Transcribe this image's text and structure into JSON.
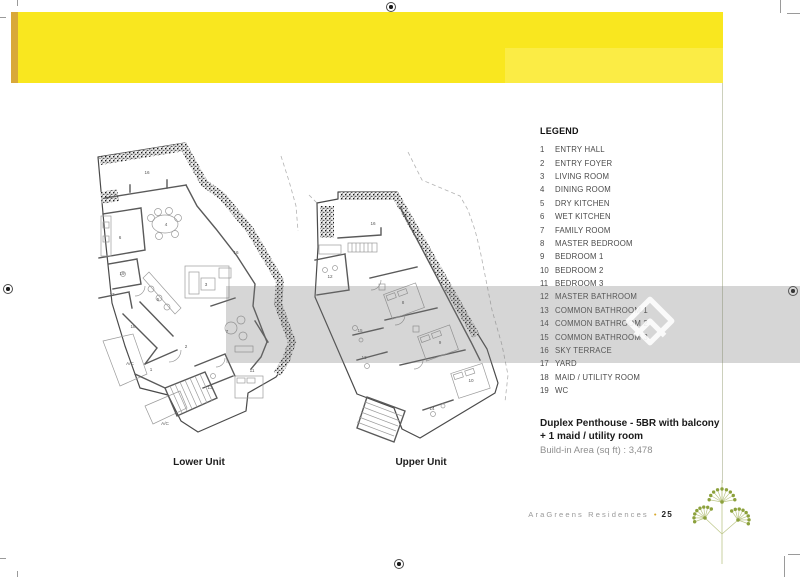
{
  "colors": {
    "banner_yellow": "#f9e71f",
    "banner_strip": "#d9a93a",
    "logo_green": "#8ca13c",
    "footer_bullet": "#d8a92c"
  },
  "legend": {
    "title": "LEGEND",
    "items": [
      {
        "num": "1",
        "label": "ENTRY HALL"
      },
      {
        "num": "2",
        "label": "ENTRY FOYER"
      },
      {
        "num": "3",
        "label": "LIVING ROOM"
      },
      {
        "num": "4",
        "label": "DINING ROOM"
      },
      {
        "num": "5",
        "label": "DRY KITCHEN"
      },
      {
        "num": "6",
        "label": "WET KITCHEN"
      },
      {
        "num": "7",
        "label": "FAMILY ROOM"
      },
      {
        "num": "8",
        "label": "MASTER BEDROOM"
      },
      {
        "num": "9",
        "label": "BEDROOM 1"
      },
      {
        "num": "10",
        "label": "BEDROOM 2"
      },
      {
        "num": "11",
        "label": "BEDROOM 3"
      },
      {
        "num": "12",
        "label": "MASTER BATHROOM"
      },
      {
        "num": "13",
        "label": "COMMON BATHROOM 1"
      },
      {
        "num": "14",
        "label": "COMMON BATHROOM 2"
      },
      {
        "num": "15",
        "label": "COMMON BATHROOM 3"
      },
      {
        "num": "16",
        "label": "SKY TERRACE"
      },
      {
        "num": "17",
        "label": "YARD"
      },
      {
        "num": "18",
        "label": "MAID / UTILITY ROOM"
      },
      {
        "num": "19",
        "label": "WC"
      }
    ]
  },
  "unit_info": {
    "title_line1": "Duplex Penthouse - 5BR with balcony",
    "title_line2": "+ 1 maid / utility room",
    "area_line": "Build-in Area (sq ft) : 3,478"
  },
  "plans": {
    "lower": {
      "caption": "Lower Unit",
      "labels": [
        {
          "t": "16",
          "x": 62,
          "y": 38
        },
        {
          "t": "4",
          "x": 81,
          "y": 90
        },
        {
          "t": "6",
          "x": 35,
          "y": 103
        },
        {
          "t": "16",
          "x": 151,
          "y": 118
        },
        {
          "t": "3",
          "x": 121,
          "y": 150
        },
        {
          "t": "5",
          "x": 73,
          "y": 165
        },
        {
          "t": "7",
          "x": 142,
          "y": 197
        },
        {
          "t": "18",
          "x": 48,
          "y": 192
        },
        {
          "t": "17",
          "x": 27,
          "y": 160
        },
        {
          "t": "19",
          "x": 37,
          "y": 139
        },
        {
          "t": "2",
          "x": 101,
          "y": 212
        },
        {
          "t": "1",
          "x": 66,
          "y": 235
        },
        {
          "t": "13",
          "x": 125,
          "y": 253
        },
        {
          "t": "11",
          "x": 167,
          "y": 236
        },
        {
          "t": "A/C",
          "x": 45,
          "y": 229,
          "s": 3.6
        },
        {
          "t": "A/C",
          "x": 80,
          "y": 289,
          "s": 3.6
        }
      ]
    },
    "upper": {
      "caption": "Upper Unit",
      "labels": [
        {
          "t": "16",
          "x": 68,
          "y": 75
        },
        {
          "t": "12",
          "x": 25,
          "y": 128
        },
        {
          "t": "8",
          "x": 98,
          "y": 154
        },
        {
          "t": "9",
          "x": 135,
          "y": 194
        },
        {
          "t": "15",
          "x": 55,
          "y": 182
        },
        {
          "t": "13",
          "x": 59,
          "y": 209
        },
        {
          "t": "10",
          "x": 166,
          "y": 232
        },
        {
          "t": "14",
          "x": 127,
          "y": 260
        }
      ]
    }
  },
  "footer": {
    "brand": "AraGreens Residences",
    "separator": "•",
    "page_number": "25"
  }
}
